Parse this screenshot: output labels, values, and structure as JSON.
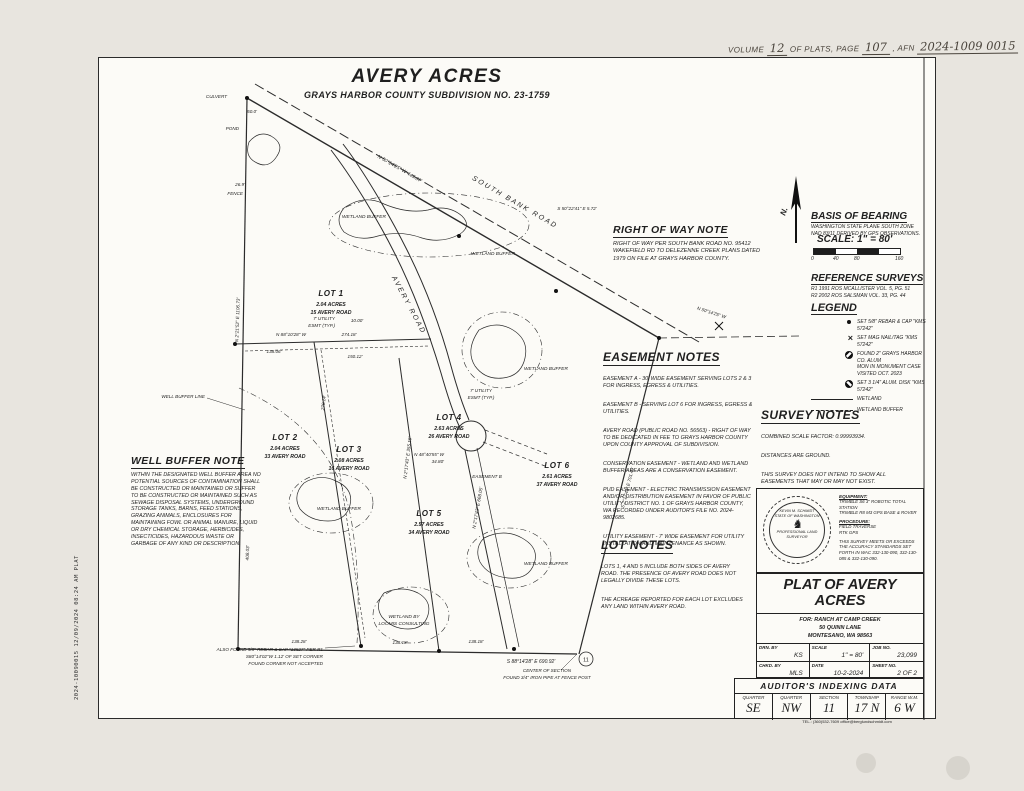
{
  "recording_line": {
    "volume_label": "VOLUME",
    "volume": "12",
    "plats_label": "OF PLATS, PAGE",
    "page": "107",
    "afn_label": ", AFN",
    "afn": "2024-1009 0015"
  },
  "title": {
    "main": "AVERY ACRES",
    "subtitle": "GRAYS HARBOR COUNTY SUBDIVISION NO. 23-1759"
  },
  "vertical_stamp": "2024-10090015  12/09/2024 08:24 AM  PLAT",
  "north_label": "N.",
  "basis_of_bearing": {
    "heading": "BASIS OF BEARING",
    "body": [
      "WASHINGTON STATE PLANE SOUTH ZONE",
      "NAD 83/11 DERIVED BY GPS OBSERVATIONS."
    ]
  },
  "scale": {
    "heading": "SCALE: 1\" = 80'",
    "ticks": [
      "0",
      "40",
      "80",
      "160"
    ]
  },
  "reference_surveys": {
    "heading": "REFERENCE SURVEYS",
    "body": [
      "R1 1991 ROS MCALLISTER VOL. 5, PG. 51",
      "R2 2002 ROS SALSMAN VOL. 33, PG. 44"
    ]
  },
  "legend": {
    "heading": "LEGEND",
    "items": [
      {
        "symbol": "set-rebar-dot",
        "text": "SET 5/8\" REBAR & CAP \"KMS 57242\""
      },
      {
        "symbol": "mag-nail-x",
        "text": "SET MAG NAIL/TAG \"KMS 57242\""
      },
      {
        "symbol": "found-monument",
        "text": [
          "FOUND 2\" GRAYS HARBOR CO. ALUM",
          "MON IN MONUMENT CASE VISITED OCT. 2023"
        ]
      },
      {
        "symbol": "alum-disk",
        "text": "SET 3 1/4\" ALUM. DISK \"KMS 57242\""
      },
      {
        "symbol": "wetland-line",
        "text": "WETLAND"
      },
      {
        "symbol": "wetland-buffer-line",
        "text": "WETLAND BUFFER"
      }
    ]
  },
  "right_of_way_note": {
    "heading": "RIGHT OF WAY NOTE",
    "body": "RIGHT OF WAY PER SOUTH BANK ROAD NO. 95412 WAKEFIELD RD TO DELEZENNE CREEK PLANS DATED 1979 ON FILE AT GRAYS HARBOR COUNTY."
  },
  "easement_notes": {
    "heading": "EASEMENT NOTES",
    "paragraphs": [
      "EASEMENT A - 30' WIDE EASEMENT SERVING LOTS 2 & 3 FOR INGRESS, EGRESS & UTILITIES.",
      "EASEMENT B - SERVING LOT 6 FOR INGRESS, EGRESS & UTILITIES.",
      "AVERY ROAD (PUBLIC ROAD NO. 56563) - RIGHT OF WAY TO BE DEDICATED IN FEE TO GRAYS HARBOR COUNTY UPON COUNTY APPROVAL OF SUBDIVISION.",
      "CONSERVATION EASEMENT - WETLAND AND WETLAND BUFFER AREAS ARE A CONSERVATION EASEMENT.",
      "PUD EASEMENT - ELECTRIC TRANSMISSION EASEMENT AND/OR DISTRIBUTION EASEMENT IN FAVOR OF PUBLIC UTILITY DISTRICT NO. 1 OF GRAYS HARBOR COUNTY, WA RECORDED UNDER AUDITOR'S FILE NO. 2024-9802685.",
      "UTILITY EASEMENT - 7' WIDE EASEMENT FOR UTILITY INSTALLATION AND MAINTENANCE AS SHOWN."
    ]
  },
  "survey_notes": {
    "heading": "SURVEY NOTES",
    "paragraphs": [
      "COMBINED SCALE FACTOR: 0.99993934.",
      "DISTANCES ARE GROUND.",
      "THIS SURVEY DOES NOT INTEND TO SHOW ALL EASEMENTS THAT MAY OR MAY NOT EXIST.",
      "BERGLUND SCHMIDT & ASSOC., INC. DOES NOT PURPORT TO SHOW OR WARRANTY TO ADVERSE POSSESSION, ESTOPPEL, UNRECORDED RIGHTS OR ANY OTHER UNWRITTEN MATTERS OF TITLE THAT MAY EXIST."
    ]
  },
  "well_buffer_note": {
    "heading": "WELL BUFFER NOTE",
    "body": "WITHIN THE DESIGNATED WELL BUFFER AREA NO POTENTIAL SOURCES OF CONTAMINATION SHALL BE CONSTRUCTED OR MAINTAINED OR SUFFER TO BE CONSTRUCTED OR MAINTAINED SUCH AS SEWAGE DISPOSAL SYSTEMS, UNDERGROUND STORAGE TANKS, BARNS, FEED STATIONS, GRAZING ANIMALS, ENCLOSURES FOR MAINTAINING FOWL OR ANIMAL MANURE, LIQUID OR DRY CHEMICAL STORAGE, HERBICIDES, INSECTICIDES, HAZARDOUS WASTE OR GARBAGE OF ANY KIND OR DESCRIPTION."
  },
  "lot_notes": {
    "heading": "LOT NOTES",
    "paragraphs": [
      "LOTS 1, 4 AND 5 INCLUDE BOTH SIDES OF AVERY ROAD. THE PRESENCE OF AVERY ROAD DOES NOT LEGALLY DIVIDE THESE LOTS.",
      "THE ACREAGE REPORTED FOR EACH LOT EXCLUDES ANY LAND WITHIN AVERY ROAD."
    ]
  },
  "stamp_block": {
    "seal": [
      "KEVIN M. SCHMIDT",
      "STATE OF WASHINGTON",
      "PROFESSIONAL LAND SURVEYOR"
    ],
    "equipment_label": "EQUIPMENT:",
    "equipment": [
      "TRIMBLE S6 3\" ROBOTIC TOTAL STATION",
      "TRIMBLE R8 M3 GPS BASE & ROVER"
    ],
    "procedure_label": "PROCEDURE:",
    "procedure": [
      "FIELD TRAVERSE",
      "RTK GPS"
    ],
    "accuracy": "THIS SURVEY MEETS OR EXCEEDS THE ACCURACY STANDARDS SET FORTH IN WAC 332-130-090, 332-130-085 & 332-130-090."
  },
  "title_block": {
    "title": "PLAT OF AVERY ACRES",
    "for_lines": [
      "FOR:  RANCH AT CAMP CREEK",
      "50 QUINN LANE",
      "MONTESANO, WA 98563"
    ],
    "cells": [
      {
        "label": "DRN. BY",
        "value": "KS"
      },
      {
        "label": "SCALE",
        "value": "1\" = 80'"
      },
      {
        "label": "JOB NO.",
        "value": "23,099"
      },
      {
        "label": "CHKD. BY",
        "value": "MLS"
      },
      {
        "label": "DATE",
        "value": "10-2-2024"
      },
      {
        "label": "SHEET NO.",
        "value": "2 OF 2"
      }
    ],
    "firm_name": "Berglund, Schmidt & Assoc., Inc.",
    "firm_sub": "PROFESSIONAL LAND SURVEYORS",
    "firm_addr": [
      "2023 BAY AVENUE",
      "HOQUIAM, WA 98550"
    ],
    "firm_tel": "TEL.: (360)532-7609    office@berglundschmidt.com"
  },
  "auditor": {
    "heading": "AUDITOR'S  INDEXING  DATA",
    "columns": [
      {
        "label": "QUARTER",
        "value": "SE"
      },
      {
        "label": "QUARTER",
        "value": "NW"
      },
      {
        "label": "SECTION",
        "value": "11"
      },
      {
        "label": "TOWNSHIP",
        "value": "17 N"
      },
      {
        "label": "RANGE W.M.",
        "value": "6 W"
      }
    ]
  },
  "map": {
    "roads": {
      "south_bank": "SOUTH BANK ROAD",
      "avery": "AVERY ROAD"
    },
    "lots": [
      {
        "name": "LOT 1",
        "acres": "2.04 ACRES",
        "address": "15 AVERY ROAD"
      },
      {
        "name": "LOT 2",
        "acres": "2.04 ACRES",
        "address": "33 AVERY ROAD"
      },
      {
        "name": "LOT 3",
        "acres": "2.08 ACRES",
        "address": "16 AVERY ROAD"
      },
      {
        "name": "LOT 4",
        "acres": "2.63 ACRES",
        "address": "26 AVERY ROAD"
      },
      {
        "name": "LOT 5",
        "acres": "2.57 ACRES",
        "address": "34 AVERY ROAD"
      },
      {
        "name": "LOT 6",
        "acres": "2.61 ACRES",
        "address": "37 AVERY ROAD"
      }
    ],
    "labels": {
      "road_bearing_1": "N 50°14'25\" W  445.07'",
      "road_bearing_2": "N 50°14'25\" W",
      "south_bearing_small": "S 50°22'41\" E  5.72'",
      "bottom_bearing": "S 88°14'28\" E  690.92'",
      "left_bearing": "N 2°21'52\" E  1106.73'",
      "east_bearing": "S 2°17'43\" E  701.40'",
      "lot23_dim": "270.14'",
      "lot3_bearing": "N 2°17'43\" E  355.16'",
      "lot4_bearing": "N 2°17'43\" E  668.05'",
      "road_dim_408": "408.03'",
      "dim_274": "274.18'",
      "bearing_n88": "N 88°10'28\" W",
      "dim_138_06": "138.06'",
      "dim_150": "150.12'",
      "dim_10": "10.00'",
      "util_esmt_l1": "7' UTILITY",
      "util_esmt_l2": "ESMT (TYP.)",
      "esmt_b": "EASEMENT B",
      "n48_l1": "N 48°40'55\" W",
      "n48_l2": "34.80'",
      "culvert": "CULVERT",
      "pond": "POND",
      "fence": "FENCE",
      "dim_26_9": "26.9'",
      "dim_50": "50.0'",
      "well_buffer_line": "WELL BUFFER LINE",
      "wetland_buffer": "WETLAND BUFFER",
      "wetland_loomis_l1": "WETLAND BY",
      "wetland_loomis_l2": "LOOMIS CONSULTING",
      "bottom_d1": "138.28'",
      "bottom_d2": "138.18'",
      "bottom_d3": "138.18'",
      "center_section_l1": "CENTER OF SECTION",
      "center_section_l2": "FOUND 3/4\" IRON PIPE AT FENCE POST",
      "also_found_l1": "ALSO FOUND 5/8\" REBAR & CAP \"13527\" PER R1",
      "also_found_l2": "S80°14'02\"W 1.12' OF SET CORNER",
      "also_found_l3": "FOUND CORNER NOT ACCEPTED",
      "section_bubble": "11"
    }
  }
}
